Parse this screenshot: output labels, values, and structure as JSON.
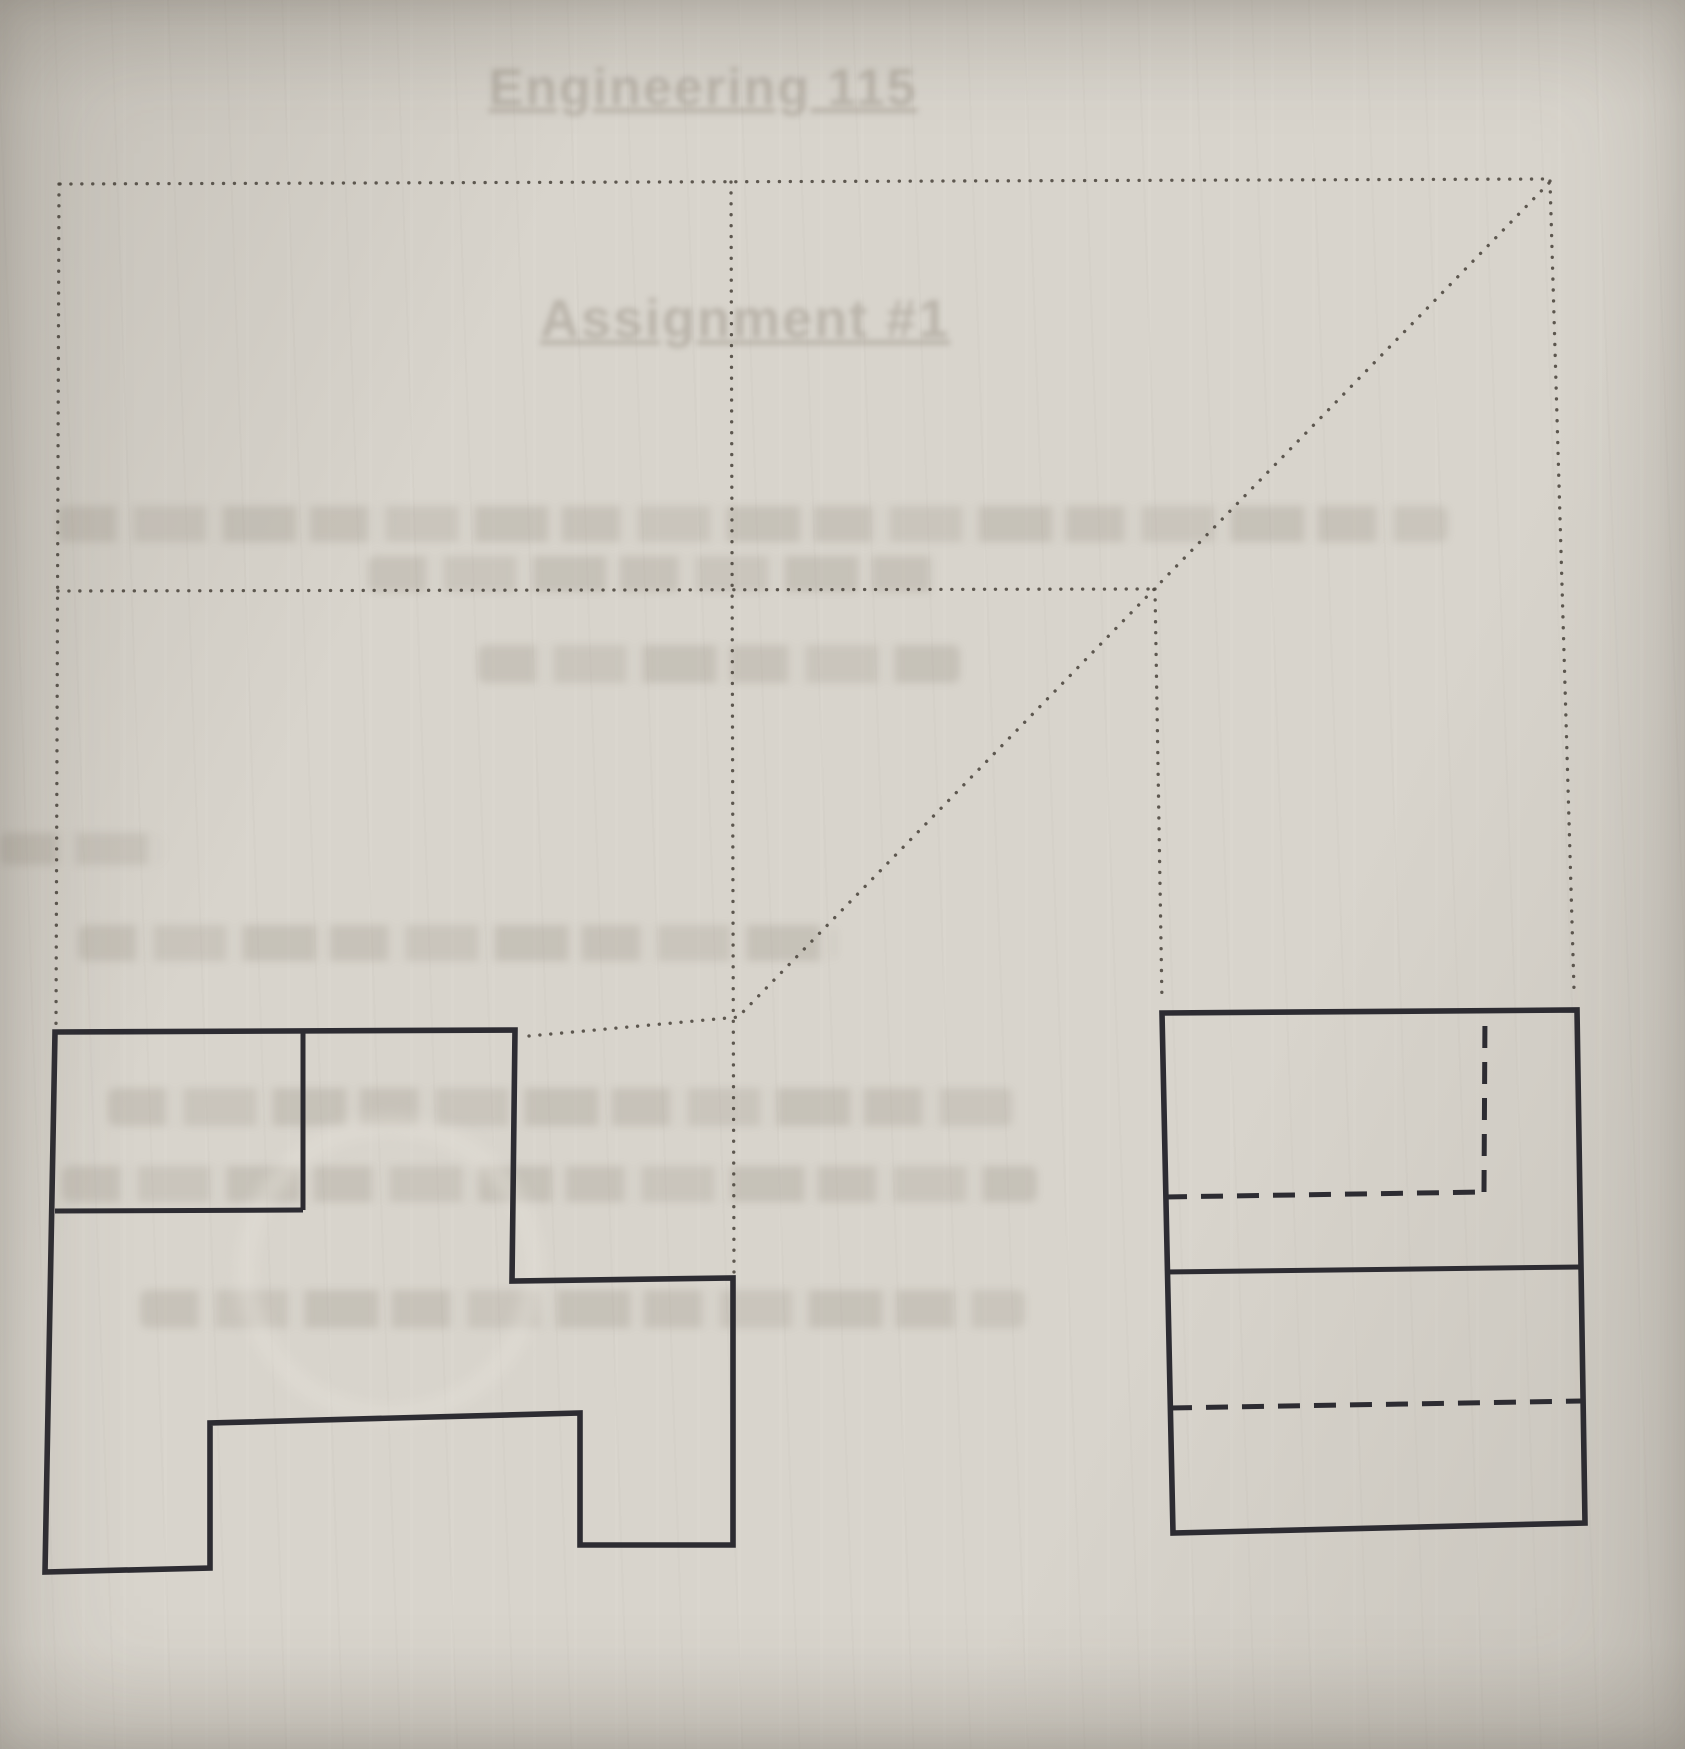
{
  "document": {
    "kind": "photographed engineering graphics worksheet",
    "views": [
      "front view (left)",
      "side view (right)"
    ]
  },
  "colors": {
    "paper": "#d8d4cc",
    "ink": "#2d2c32",
    "construction_dot": "#4b463e",
    "showthrough": "#766e61"
  },
  "showthrough": {
    "title": "Engineering 115",
    "subtitle": "Assignment #1",
    "note": "remaining show-through lines are illegible smudges",
    "bands": [
      {
        "x": 58,
        "y": 506,
        "w": 1390,
        "h": 36
      },
      {
        "x": 368,
        "y": 556,
        "w": 568,
        "h": 36
      },
      {
        "x": 478,
        "y": 645,
        "w": 482,
        "h": 38
      },
      {
        "x": 0,
        "y": 833,
        "w": 165,
        "h": 32
      },
      {
        "x": 78,
        "y": 925,
        "w": 758,
        "h": 36
      },
      {
        "x": 108,
        "y": 1088,
        "w": 905,
        "h": 38
      },
      {
        "x": 62,
        "y": 1166,
        "w": 975,
        "h": 36
      },
      {
        "x": 140,
        "y": 1290,
        "w": 885,
        "h": 38
      }
    ]
  },
  "figure": {
    "construction_lines": [
      {
        "name": "construction-top-horizontal",
        "from": [
          60,
          184
        ],
        "to": [
          1549,
          179
        ]
      },
      {
        "name": "construction-left-vertical",
        "from": [
          59,
          184
        ],
        "to": [
          56,
          1024
        ]
      },
      {
        "name": "construction-center-vertical",
        "from": [
          731,
          182
        ],
        "to": [
          734,
          1272
        ]
      },
      {
        "name": "construction-mid-horizontal",
        "from": [
          58,
          591
        ],
        "to": [
          1154,
          589
        ]
      },
      {
        "name": "construction-side-projection-vertical",
        "from": [
          1155,
          589
        ],
        "to": [
          1162,
          1002
        ]
      },
      {
        "name": "construction-right-vertical",
        "from": [
          1550,
          181
        ],
        "to": [
          1574,
          989
        ]
      },
      {
        "name": "construction-miter-diagonal",
        "from": [
          1549,
          183
        ],
        "to": [
          742,
          1013
        ]
      },
      {
        "name": "construction-front-top-projection",
        "from": [
          529,
          1036
        ],
        "to": [
          739,
          1017
        ]
      }
    ],
    "front_view": {
      "outline_name": "front-view-outline",
      "outline": [
        [
          55,
          1032
        ],
        [
          515,
          1030
        ],
        [
          512,
          1281
        ],
        [
          733,
          1278
        ],
        [
          733,
          1545
        ],
        [
          580,
          1545
        ],
        [
          580,
          1413
        ],
        [
          210,
          1423
        ],
        [
          210,
          1568
        ],
        [
          45,
          1572
        ]
      ],
      "inner_lines": [
        {
          "name": "front-view-inner-vertical",
          "from": [
            303,
            1031
          ],
          "to": [
            303,
            1210
          ]
        },
        {
          "name": "front-view-inner-horizontal",
          "from": [
            55,
            1211
          ],
          "to": [
            303,
            1210
          ]
        }
      ]
    },
    "side_view": {
      "outline_name": "side-view-outline",
      "outline": [
        [
          1162,
          1013
        ],
        [
          1577,
          1010
        ],
        [
          1585,
          1523
        ],
        [
          1173,
          1533
        ]
      ],
      "solid_lines": [
        {
          "name": "side-view-mid-horizontal",
          "from": [
            1165,
            1272
          ],
          "to": [
            1581,
            1267
          ]
        }
      ],
      "hidden_lines": [
        {
          "name": "side-view-hidden-upper-horizontal",
          "from": [
            1165,
            1197
          ],
          "to": [
            1484,
            1192
          ]
        },
        {
          "name": "side-view-hidden-vertical",
          "from": [
            1484,
            1192
          ],
          "to": [
            1485,
            1012
          ]
        },
        {
          "name": "side-view-hidden-lower-horizontal",
          "from": [
            1170,
            1408
          ],
          "to": [
            1581,
            1401
          ]
        }
      ]
    }
  }
}
